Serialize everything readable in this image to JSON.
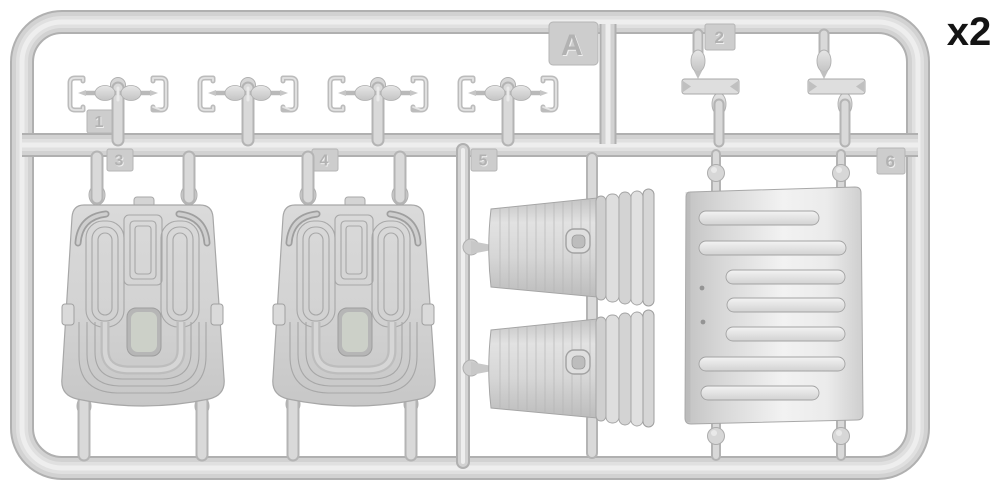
{
  "figure": {
    "sprue_label": "A",
    "quantity_label": "x2",
    "part_tabs": [
      "1",
      "2",
      "3",
      "4",
      "5",
      "6"
    ],
    "colors": {
      "plastic": "#d5d5d5",
      "plastic_shadow": "#a8a8a8",
      "plastic_highlight": "#efefef",
      "background": "#ffffff",
      "label_text": "#141414"
    }
  }
}
